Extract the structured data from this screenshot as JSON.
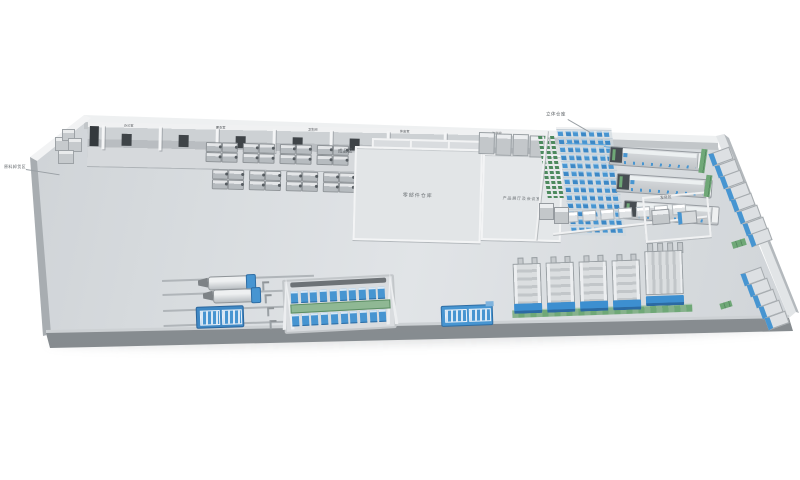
{
  "scene": {
    "type": "3D isometric factory layout rendering",
    "background": "#ffffff"
  },
  "labels": {
    "outside_left": "原料卸货区",
    "finished_area": "成品区",
    "warehouse": "零部件仓库",
    "showroom": "产品展厅及会议室",
    "asrs": "立体仓库",
    "shipping": "发货区",
    "utility_rooms": [
      "空调间",
      "空压间",
      "配电间"
    ],
    "strip_rooms": [
      "办公室",
      "更衣室",
      "卫生间",
      "休息室",
      "工具间"
    ]
  },
  "zones": {
    "office_strip": {
      "partitions": 8,
      "doors": 7
    },
    "desk_clusters": {
      "rows": 2,
      "cols": 4,
      "desks_per_cluster": 4
    },
    "cabinets": 4,
    "green_rack_cols": 3,
    "asrs": {
      "rows": 13,
      "cols": 7
    },
    "production_lines": 3,
    "workbenches": 7,
    "wall_machines": {
      "upper": 8,
      "lower": 5
    },
    "presses": 4,
    "wide_presses": 1,
    "assembly": {
      "top_stations": 10,
      "bottom_stations": 10
    },
    "conveyor_lines": 4,
    "conveyor_stands": 4
  },
  "colors": {
    "background": "#ffffff",
    "floor_light": "#e1e4e7",
    "floor_mid": "#d6dade",
    "wall_top": "#eef0f1",
    "wall_face": "#c2c6c9",
    "front_wall": "#7e8387",
    "white_wall": "#f2f3f4",
    "machine_gray": "#c6cacd",
    "machine_dark": "#474d52",
    "accent_blue": "#4795d1",
    "accent_blue_dark": "#2e6da4",
    "accent_green": "#6fa877",
    "rack_green": "#4d8a5e",
    "label_gray": "#5d6266"
  }
}
